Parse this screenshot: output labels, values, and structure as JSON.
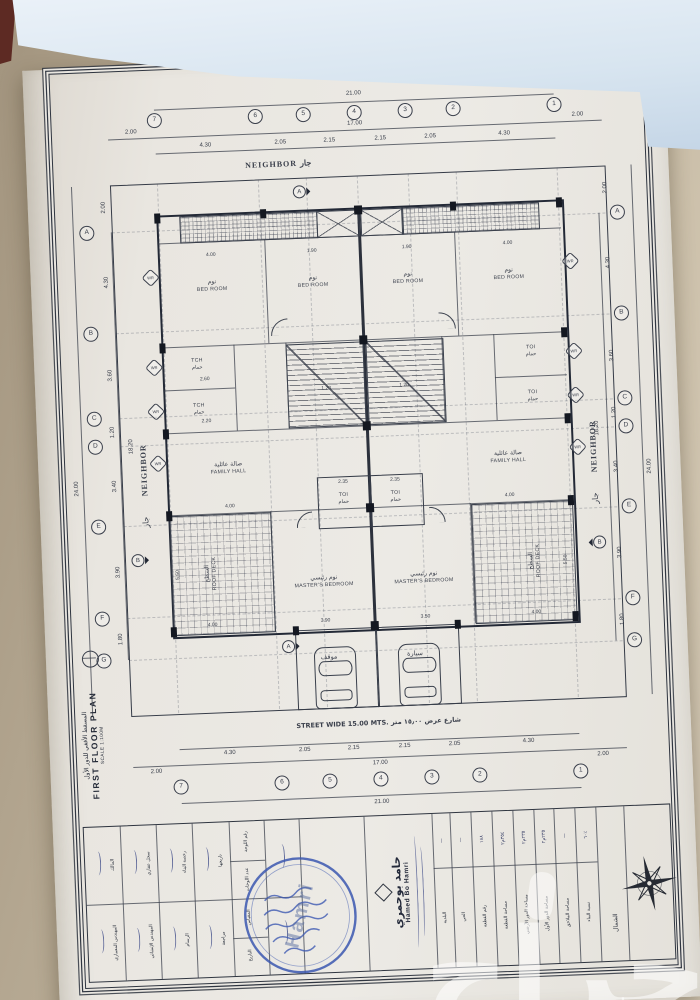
{
  "plan": {
    "overall_w": "21.00",
    "inner_w": "17.00",
    "side": "2.00",
    "overall_h": "24.00",
    "inner_h": "18.20",
    "grid_cols": [
      "7",
      "6",
      "5",
      "4",
      "3",
      "2",
      "1"
    ],
    "grid_rows": [
      "A",
      "B",
      "C",
      "D",
      "E",
      "F",
      "G"
    ],
    "col_segs": [
      "4.30",
      "2.05",
      "2.15",
      "2.15",
      "2.05",
      "4.30"
    ],
    "row_segs": [
      "4.30",
      "3.60",
      "1.20",
      "3.40",
      "3.90",
      "1.80"
    ],
    "neighbor_top": "NEIGHBOR  جار",
    "neighbor_side_en": "NEIGHBOR",
    "neighbor_side_ar": "جار",
    "street": "STREET WIDE 15.00 MTS.  شارع عرض ١٥٫٠٠ متر",
    "marker_a": "A",
    "marker_b": "B",
    "wall_marker": "WR",
    "rooms": {
      "bedroom_en": "BED ROOM",
      "bedroom_ar": "نوم",
      "family_en": "FAMILY HALL",
      "family_ar": "صالة عائلية",
      "master_en": "MASTER'S BEDROOM",
      "master_ar": "نوم رئيسي",
      "roof_en": "ROOF DECK",
      "roof_ar": "السطح",
      "tch_en": "TCH",
      "toi_en": "TOI",
      "wc_ar": "حمام",
      "parking_ar": "موقف",
      "car_ar": "سيارة"
    },
    "inner_dims": [
      "4.00",
      "1.90",
      "1.90",
      "4.00",
      "2.60",
      "2.20",
      "1.20",
      "1.20",
      "2.35",
      "2.35",
      "4.00",
      "4.00",
      "3.90",
      "3.50",
      "4.00",
      "4.00",
      "5.50",
      "5.50"
    ]
  },
  "ffp": {
    "title_ar": "المسقط الأفقي للدور الأول",
    "title_en": "FIRST FLOOR PLAN",
    "scale": "SCALE",
    "scale_val": "1:100M"
  },
  "titleblock": {
    "band1": [
      "المالك",
      "سجل عقاري",
      "رخصة البناء",
      "تاريخها"
    ],
    "band2": [
      "المهندس المعماري",
      "المهندس الإنشائي",
      "الرسام",
      "مراجعة"
    ],
    "sheetinfo": [
      "رقم اللوحة",
      "عدد اللوحات",
      "المقياس",
      "التاريخ"
    ],
    "company_ar": "حامد بوحمري",
    "company_en": "Hamed Bo Hamri",
    "stamp_overlay": "Hamri",
    "north": "الشمال",
    "table_labels": [
      "البلدية",
      "الحي",
      "رقم القطعة",
      "مساحة القطعة",
      "مساحة الدور الأرضي",
      "مساحة الدور الأول",
      "مساحة الملاحق",
      "نسبة البناء"
    ],
    "table_values": [
      "—",
      "—",
      "١٨٨",
      "٣٥٤م٢",
      "٢٣٥م٢",
      "٢٣٥م٢",
      "—",
      "٦٠٪"
    ]
  },
  "watermark": "حراج"
}
